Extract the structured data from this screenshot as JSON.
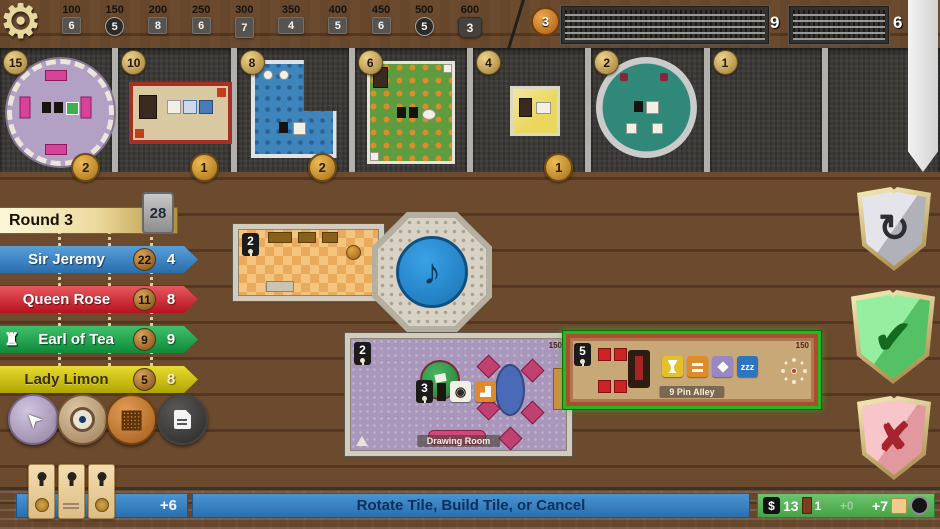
{
  "top_bar": {
    "milestones": [
      {
        "score": "100",
        "token": "6"
      },
      {
        "score": "150",
        "token": "5"
      },
      {
        "score": "200",
        "token": "8"
      },
      {
        "score": "250",
        "token": "6"
      },
      {
        "score": "300",
        "token": "7"
      },
      {
        "score": "350",
        "token": "4"
      },
      {
        "score": "400",
        "token": "5"
      },
      {
        "score": "450",
        "token": "6"
      },
      {
        "score": "500",
        "token": "5"
      },
      {
        "score": "600",
        "token": "3"
      }
    ],
    "favor_token": "3",
    "draw_stacks": [
      {
        "count": "9"
      },
      {
        "count": "6"
      }
    ]
  },
  "market": {
    "slots": [
      {
        "price": "15",
        "bonus": "2"
      },
      {
        "price": "10",
        "bonus": "1"
      },
      {
        "price": "8",
        "bonus": "2"
      },
      {
        "price": "6",
        "bonus": ""
      },
      {
        "price": "4",
        "bonus": "1"
      },
      {
        "price": "2",
        "bonus": ""
      },
      {
        "price": "1",
        "bonus": ""
      },
      {
        "price": "",
        "bonus": ""
      }
    ]
  },
  "scoreboard": {
    "round_label": "Round 3",
    "tiles_remaining": "28",
    "players": [
      {
        "name": "Sir Jeremy",
        "money": "22",
        "score": "4"
      },
      {
        "name": "Queen Rose",
        "money": "11",
        "score": "8"
      },
      {
        "name": "Earl of Tea",
        "money": "9",
        "score": "9"
      },
      {
        "name": "Lady Limon",
        "money": "5",
        "score": "8"
      }
    ]
  },
  "board": {
    "hall": {
      "marker": "2"
    },
    "drawing_room": {
      "marker": "2",
      "keyhole_value": "3",
      "name": "Drawing Room",
      "size": "150"
    },
    "nine_pin_alley": {
      "marker": "5",
      "name": "9 Pin Alley",
      "size": "150",
      "sleep_label": "zzz"
    }
  },
  "bottom_bar": {
    "income_preview": "+6",
    "prompt": "Rotate Tile, Build Tile, or Cancel",
    "money_symbol": "$",
    "money": "13",
    "doors": "1",
    "ghost_value": "+0",
    "score_delta": "+7"
  },
  "icons": {
    "gear": "⚙",
    "music_note": "♪",
    "rotate": "↻",
    "confirm": "✔",
    "cancel": "✘",
    "pointer": "➤",
    "grid": "▦",
    "rook": "♜"
  },
  "colors": {
    "selection_green": "#25b825",
    "accent_blue": "#2e7fc0",
    "status_green": "#55b055"
  }
}
